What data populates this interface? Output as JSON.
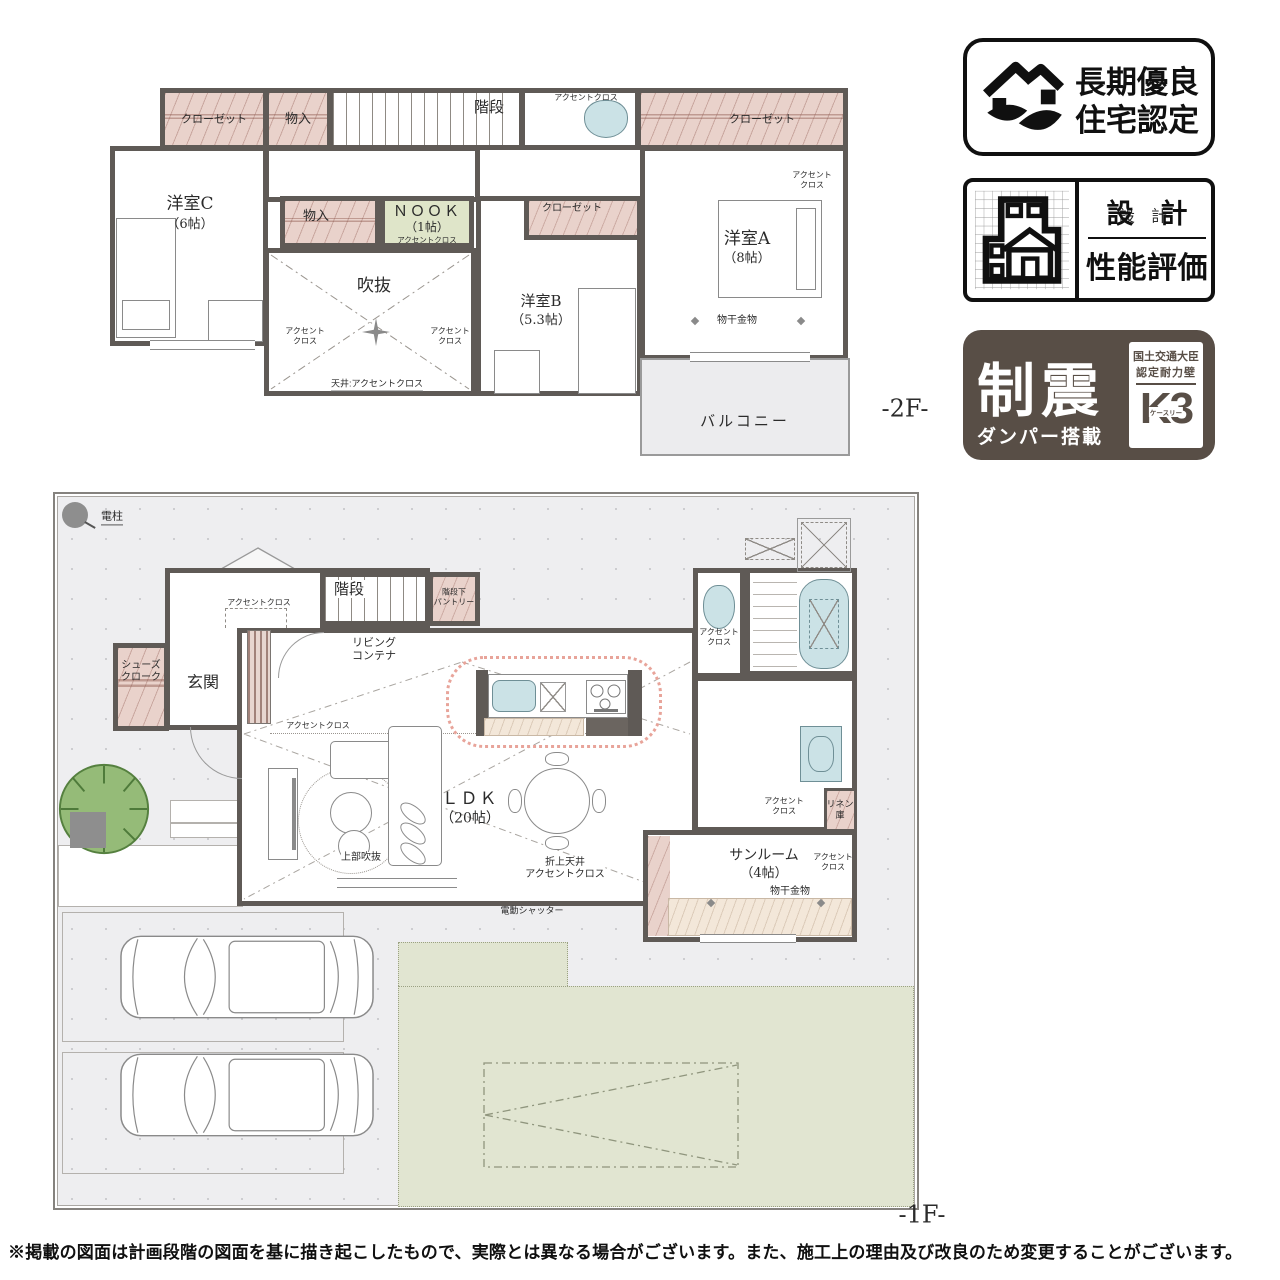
{
  "plan2f": {
    "floor_tag": "-2F-",
    "labels": {
      "closet_left": "クローゼット",
      "storage_top": "物入",
      "stairs": "階段",
      "toilet_accent": "アクセントクロス",
      "closet_right": "クローゼット",
      "bedroom_c": "洋室C",
      "bedroom_c_size": "（6帖）",
      "storage_mid": "物入",
      "nook": "ＮＯＯＫ",
      "nook_size": "（1帖）",
      "nook_accent": "アクセントクロス",
      "void": "吹抜",
      "void_accent_left": "アクセント\nクロス",
      "void_accent_right": "アクセント\nクロス",
      "void_ceiling": "天井:アクセントクロス",
      "bedroom_b": "洋室B",
      "bedroom_b_size": "（5.3帖）",
      "closet_b": "クローゼット",
      "bedroom_a": "洋室A",
      "bedroom_a_size": "（8帖）",
      "bedroom_a_accent": "アクセント\nクロス",
      "drying": "物干金物",
      "balcony": "バルコニー"
    }
  },
  "plan1f": {
    "floor_tag": "-1F-",
    "labels": {
      "pole": "電柱",
      "stairs": "階段",
      "pantry": "階段下\nパントリー",
      "hall_accent": "アクセントクロス",
      "living_container": "リビング\nコンテナ",
      "shoes_closet": "シューズ\nクローク",
      "entrance": "玄関",
      "ldk_accent": "アクセントクロス",
      "ldk": "ＬＤＫ",
      "ldk_size": "（20帖）",
      "upper_void": "上部吹抜",
      "folded_ceiling": "折上天井\nアクセントクロス",
      "shutter": "電動シャッター",
      "toilet_accent": "アクセント\nクロス",
      "washroom_accent": "アクセント\nクロス",
      "linen": "リネン\n庫",
      "sunroom": "サンルーム",
      "sunroom_size": "（4帖）",
      "sunroom_drying": "物干金物",
      "sunroom_accent": "アクセント\nクロス"
    }
  },
  "badges": {
    "choki": {
      "line1": "長期優良",
      "line2": "住宅認定"
    },
    "sekkei": {
      "top": "設　計",
      "bottom": "性能評価"
    },
    "seishin": {
      "big": "制震",
      "sub": "ダンパー搭載",
      "right1": "国土交通大臣",
      "right2": "認定耐力壁",
      "logo": "K3",
      "logo_sub": "ケースリー"
    }
  },
  "disclaimer": "※掲載の図面は計画段階の図面を基に描き起こしたもので、実際とは異なる場合がございます。また、施工上の理由及び改良のため変更することがございます。"
}
